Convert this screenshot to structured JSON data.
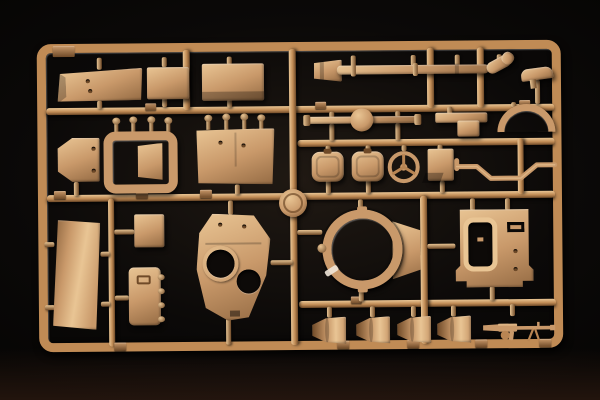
{
  "scene": {
    "subject": "Photograph of a sand-tan injection-molded model kit sprue (tank parts) on a black background",
    "visible_text": "none legible (small embossed part-number tabs and a round maker medallion are present but unreadable)"
  },
  "colors": {
    "background": "#0b0908",
    "glow": "#201913",
    "reflection": "#3a2115",
    "plastic_highlight": "#e9c594",
    "plastic_mid": "#c9996a",
    "plastic_shadow": "#6f4a28",
    "runner": "#c08b55",
    "hole": "#0d0a08",
    "glint": "#efe6d8"
  },
  "parts": [
    {
      "name": "stowage-bin-long"
    },
    {
      "name": "stowage-box-small"
    },
    {
      "name": "stowage-panel"
    },
    {
      "name": "exhaust-muffler-end"
    },
    {
      "name": "exhaust-pipe"
    },
    {
      "name": "pipe-elbow"
    },
    {
      "name": "curved-handle"
    },
    {
      "name": "axle-with-differential"
    },
    {
      "name": "mount-bracket"
    },
    {
      "name": "fender-arch"
    },
    {
      "name": "round-hatch-left"
    },
    {
      "name": "round-hatch-right"
    },
    {
      "name": "steering-wheel"
    },
    {
      "name": "small-bin"
    },
    {
      "name": "stepped-tow-rod"
    },
    {
      "name": "angled-plate"
    },
    {
      "name": "seat-frame"
    },
    {
      "name": "floor-panel"
    },
    {
      "name": "hull-side-plate"
    },
    {
      "name": "small-panel"
    },
    {
      "name": "hinged-hatch-door"
    },
    {
      "name": "turret-roof"
    },
    {
      "name": "turret-ring"
    },
    {
      "name": "rear-panel-frame"
    },
    {
      "name": "conical-hub-1"
    },
    {
      "name": "conical-hub-2"
    },
    {
      "name": "conical-hub-3"
    },
    {
      "name": "conical-hub-4"
    },
    {
      "name": "machine-gun"
    },
    {
      "name": "sprue-logo-medallion"
    },
    {
      "name": "sprue-letter-tab"
    }
  ]
}
